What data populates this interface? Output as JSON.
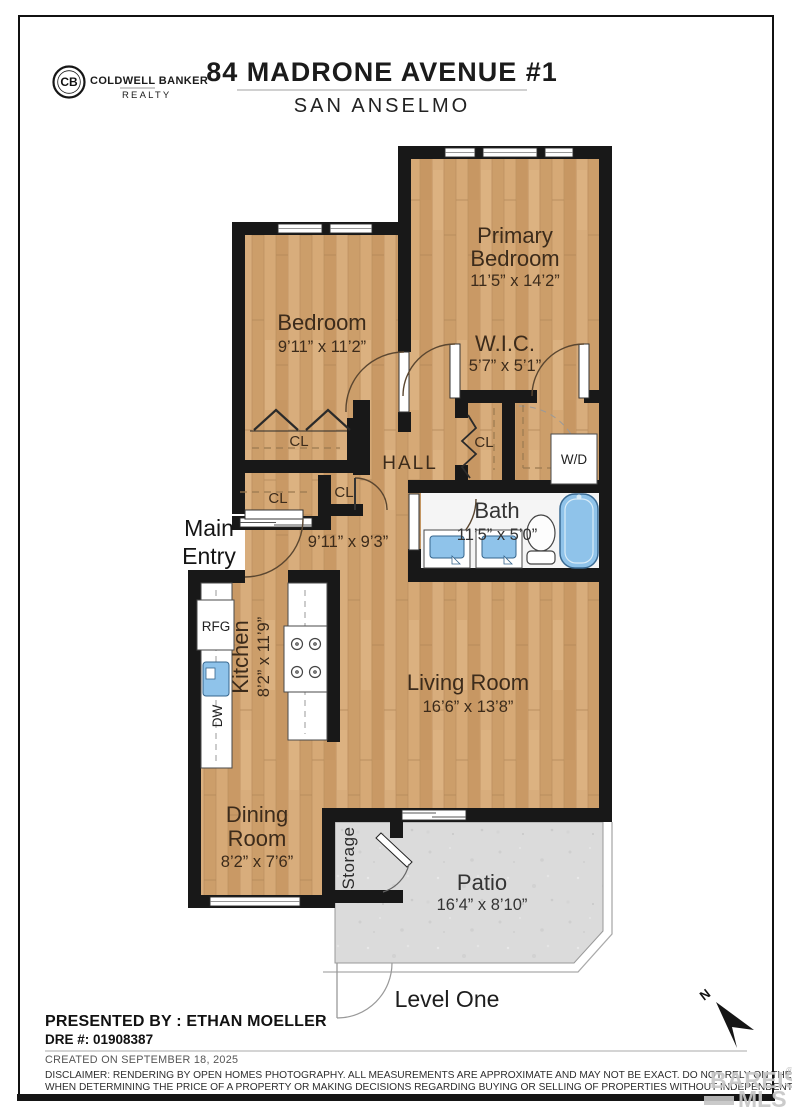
{
  "header": {
    "brand_line1": "COLDWELL BANKER",
    "brand_line2": "REALTY",
    "monogram": "CB",
    "title": "84 MADRONE AVENUE #1",
    "subtitle": "SAN ANSELMO"
  },
  "floorplan": {
    "rooms": {
      "primary": {
        "line1": "Primary",
        "line2": "Bedroom",
        "dims": "11’5” x 14’2”"
      },
      "bedroom": {
        "name": "Bedroom",
        "dims": "9’11” x 11’2”"
      },
      "wic": {
        "name": "W.I.C.",
        "dims": "5’7” x 5’1”"
      },
      "hall": {
        "name": "HALL",
        "dims": "9’11” x 9’3”"
      },
      "bath": {
        "name": "Bath",
        "dims": "11’5” x 5’0”"
      },
      "kitchen": {
        "name": "Kitchen",
        "dims": "8’2” x 11’9”"
      },
      "living": {
        "name": "Living Room",
        "dims": "16’6” x 13’8”"
      },
      "dining": {
        "line1": "Dining",
        "line2": "Room",
        "dims": "8’2” x 7’6”"
      },
      "patio": {
        "name": "Patio",
        "dims": "16’4” x 8’10”"
      }
    },
    "labels": {
      "main_entry_line1": "Main",
      "main_entry_line2": "Entry",
      "storage": "Storage",
      "closet": "CL",
      "fridge": "RFG",
      "dishwasher": "DW",
      "washer_dryer": "W/D",
      "level": "Level One",
      "north": "N"
    },
    "colors": {
      "wood": "#d3a674",
      "wall": "#181818",
      "bath_floor": "#f5f5f5",
      "patio_concrete": "#dbdbdb",
      "fixture_blue": "#8fc3ea",
      "label_brown": "#3c2b1b"
    }
  },
  "footer": {
    "presented_by": "PRESENTED BY : ETHAN MOELLER",
    "dre": "DRE #: 01908387",
    "created": "CREATED ON SEPTEMBER 18, 2025",
    "disclaimer_line1": "DISCLAIMER: RENDERING BY OPEN HOMES PHOTOGRAPHY. ALL MEASUREMENTS ARE APPROXIMATE AND MAY NOT BE EXACT. DO NOT RELY ON THE ACCURACY OF THIS FLOOR PLAN",
    "disclaimer_line2": "WHEN DETERMINING THE PRICE OF A PROPERTY OR MAKING DECISIONS REGARDING BUYING OR SELLING OF PROPERTIES WITHOUT INDEPENDENT VERIFICATION.",
    "watermark_line1": "BAREIS",
    "watermark_reg": "®",
    "watermark_line2": "MLS"
  }
}
